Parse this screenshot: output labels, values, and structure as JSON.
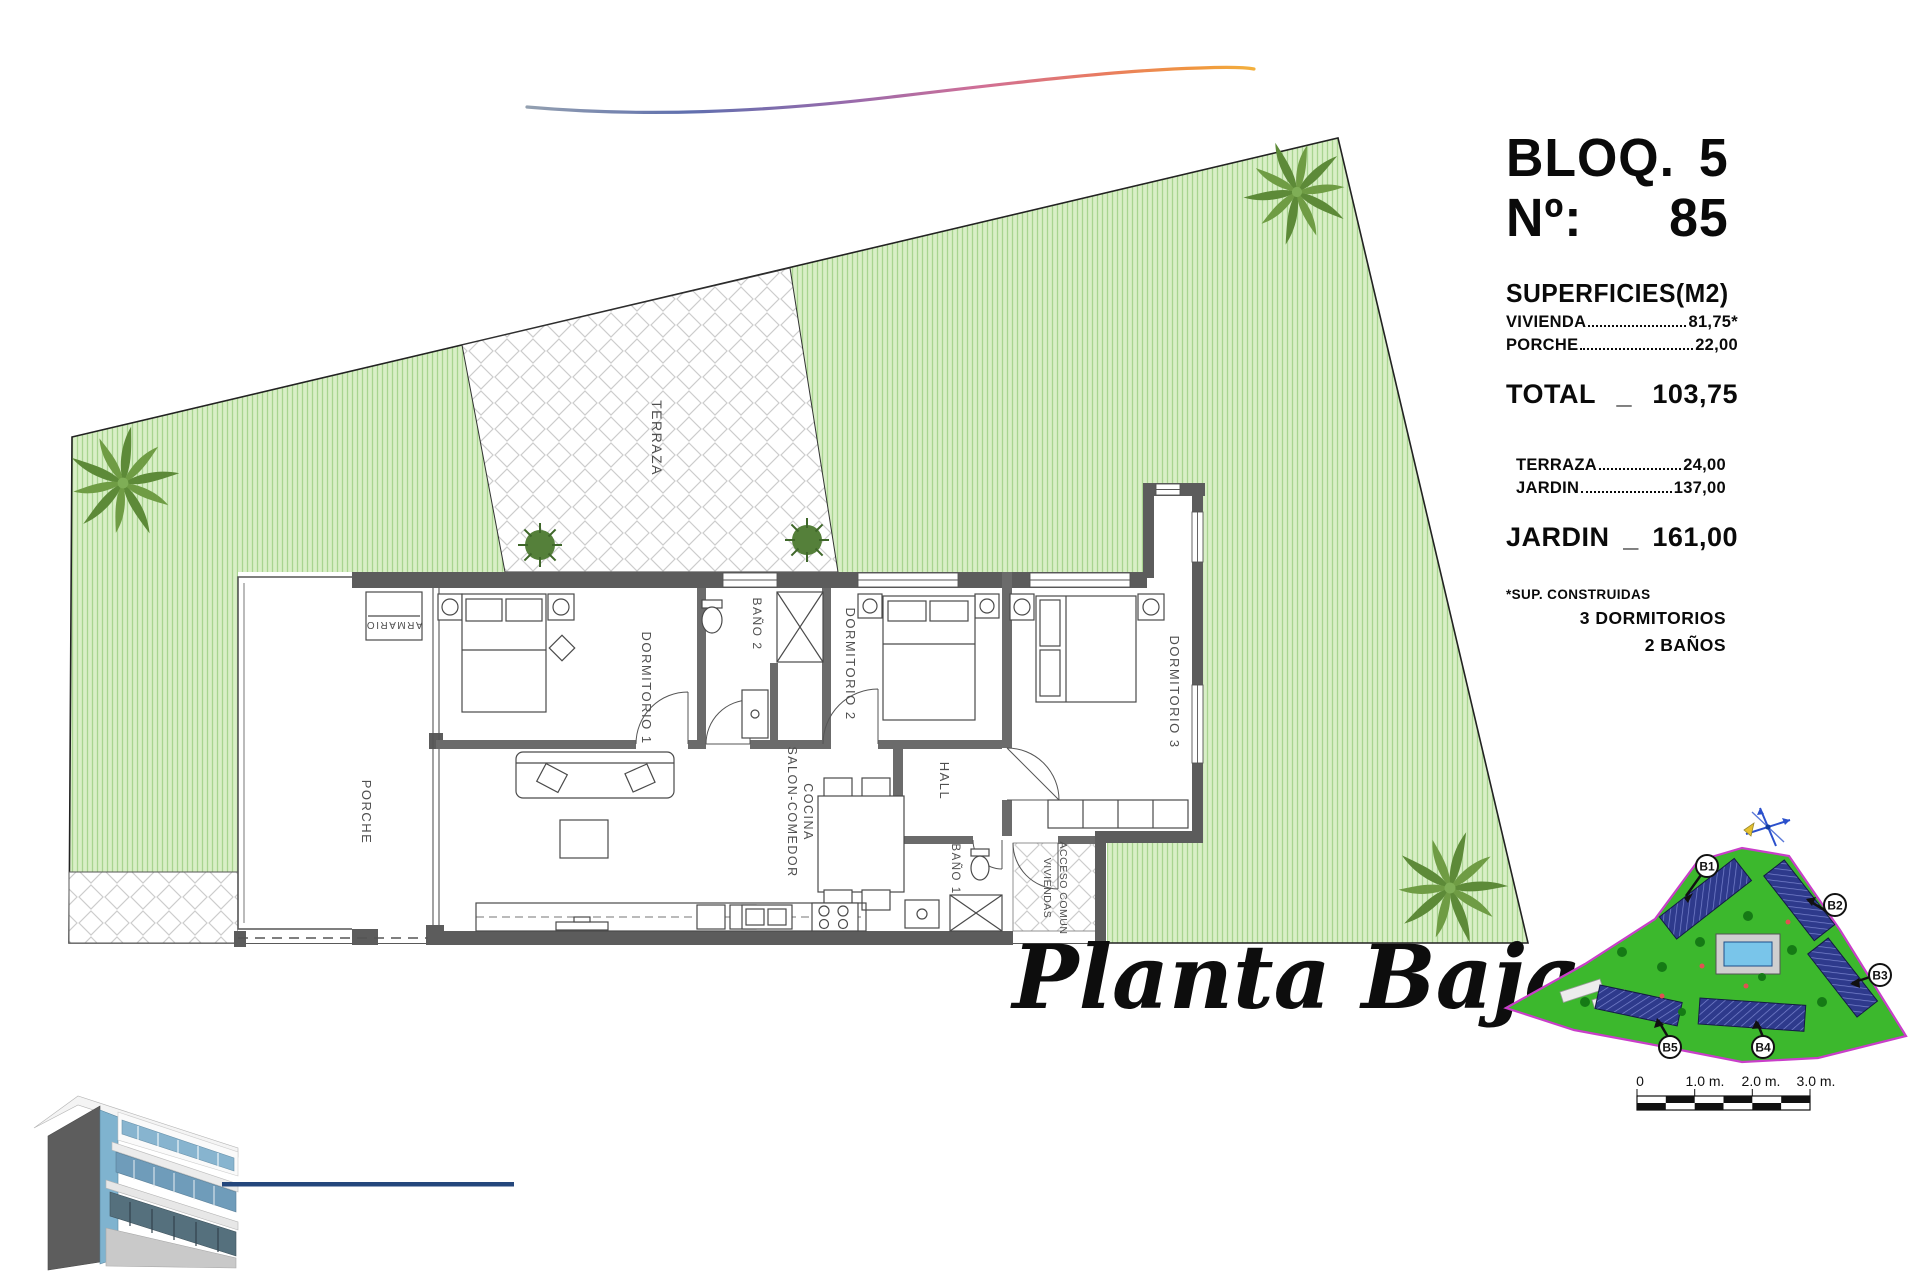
{
  "panel": {
    "block": {
      "label": "BLOQ.",
      "value": "5"
    },
    "number": {
      "label": "Nº:",
      "value": "85"
    },
    "superficies_title": "SUPERFICIES(M2)",
    "vivienda": {
      "label": "VIVIENDA",
      "value": "81,75*"
    },
    "porche": {
      "label": "PORCHE",
      "value": "22,00"
    },
    "total": {
      "label": "TOTAL",
      "sep": "_",
      "value": "103,75"
    },
    "terraza": {
      "label": "TERRAZA",
      "value": "24,00"
    },
    "jardin": {
      "label": "JARDIN",
      "value": "137,00"
    },
    "jardin_total": {
      "label": "JARDIN",
      "sep": "_",
      "value": "161,00"
    },
    "footnote": "*SUP. CONSTRUIDAS",
    "feature1": "3 DORMITORIOS",
    "feature2": "2 BAÑOS"
  },
  "plan": {
    "caption": "Planta Baja",
    "rooms": {
      "terraza": "TERRAZA",
      "porche": "PORCHE",
      "armario": "ARMARIO",
      "dormitorio1": "DORMITORIO 1",
      "bano2": "BAÑO 2",
      "dormitorio2": "DORMITORIO 2",
      "dormitorio3": "DORMITORIO 3",
      "hall": "HALL",
      "salon_line1": "SALON-COMEDOR",
      "salon_line2": "COCINA",
      "bano1": "BAÑO 1",
      "acceso_line1": "ACCESO COMUN",
      "acceso_line2": "VIVIENDAS"
    }
  },
  "siteplan": {
    "b1": "B1",
    "b2": "B2",
    "b3": "B3",
    "b4": "B4",
    "b5": "B5"
  },
  "scalebar": {
    "t0": "0",
    "t1": "1.0 m.",
    "t2": "2.0 m.",
    "t3": "3.0 m."
  },
  "colors": {
    "garden_green": "#d9efc7",
    "garden_stripe": "#a8d490",
    "map_green": "#3cb82d",
    "map_boundary": "#c93ec9",
    "building_navy": "#2e3a8c",
    "pool_blue": "#79c5ea",
    "wall_gray": "#5c5c5c",
    "swoosh_blue": "#5f6fae",
    "swoosh_pink": "#cf6f97",
    "swoosh_orange": "#f0963f",
    "line_navy": "#24477c"
  }
}
